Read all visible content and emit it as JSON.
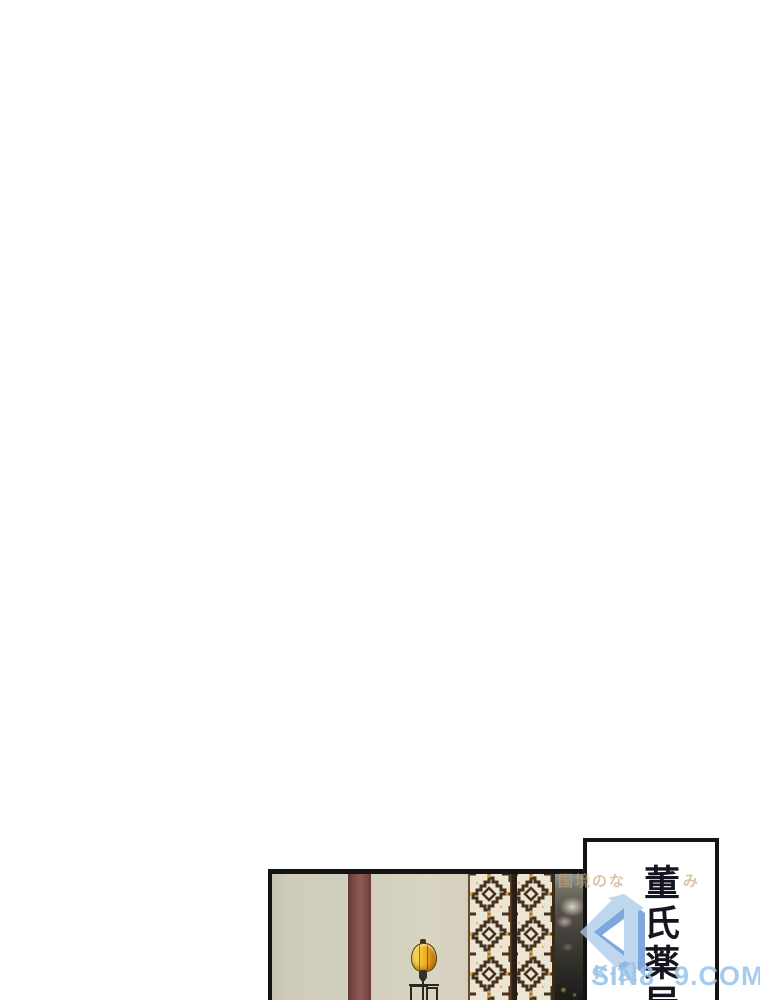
{
  "page": {
    "width": 760,
    "height": 1000,
    "background": "#ffffff"
  },
  "panel": {
    "border_color": "#141414",
    "wall_left_color": "#cfccbc",
    "pillar_color": "#82504c",
    "wall_right_color": "#d7d3c1",
    "lattice_bg_color": "#ece5d3",
    "lattice_fret_color": "#46321f",
    "lattice_gold_color": "#d19a3c",
    "lattice_divider_color": "#2f2318",
    "mural_dark_color": "#35332c",
    "lantern_body_color": "#eeb22b",
    "lantern_stand_color": "#2c2620"
  },
  "speech_box": {
    "text": "董氏薬局",
    "text_color": "#15151f",
    "border_color": "#141414",
    "background": "#ffffff"
  },
  "watermark": {
    "slogan_left": "国境のな",
    "slogan_right": "み",
    "slogan_color": "#c9a170",
    "logo_label": "K-漫",
    "domain_left": "SIN8",
    "domain_right": "9.COM",
    "logo_blue_dark": "#5b8fd4",
    "logo_blue_light": "#aecdea",
    "text_blue_color": "#9cc4ea"
  }
}
